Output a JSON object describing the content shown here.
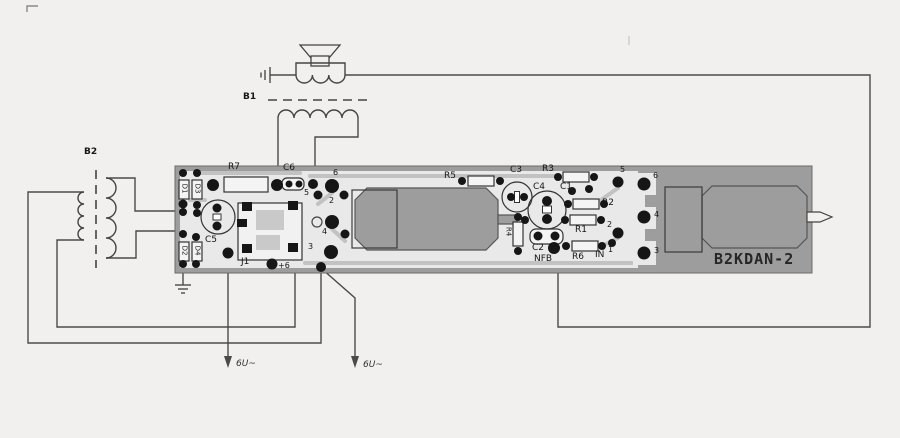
{
  "diagram": {
    "board_name": "B2KDAN-2",
    "transformer_top": "B1",
    "transformer_left": "B2",
    "supply_label_left": "6U~",
    "supply_label_right": "6U~",
    "plus_six": "+6",
    "refs": {
      "r7": "R7",
      "c6": "C6",
      "c5": "C5",
      "j1": "J1",
      "d1": "D1",
      "d3": "D3",
      "d2": "D2",
      "d4": "D4",
      "r5": "R5",
      "c3": "C3",
      "r3": "R3",
      "c4": "C4",
      "c1": "C1",
      "r2": "R2",
      "r1": "R1",
      "r4": "R4",
      "c2": "C2",
      "nfb": "NFB",
      "r6": "R6",
      "in_label": "IN"
    },
    "socket_left_pins": {
      "p6": "6",
      "p5": "5",
      "p2": "2",
      "p4": "4",
      "p1": "1",
      "p3": "3"
    },
    "socket_right_pins": {
      "p5": "5",
      "p2": "2",
      "p1": "1"
    },
    "module_pins": {
      "p6": "6",
      "p4": "4",
      "p3": "3"
    }
  },
  "colors": {
    "background": "#f1f0ee",
    "board_gray": "#9d9d9d",
    "board_light_zone": "#e9e9e9",
    "trace_gray": "#c2c2c2",
    "pad_black": "#161616",
    "wire": "#4a4a4a"
  }
}
